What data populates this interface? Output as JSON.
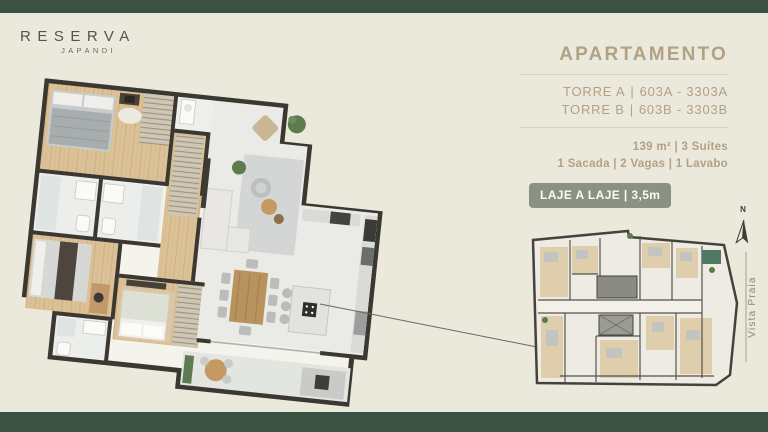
{
  "brand": {
    "name": "RESERVA",
    "sub": "JAPANDI"
  },
  "panel": {
    "title": "APARTAMENTO",
    "separator": "|",
    "towers": [
      {
        "label": "TORRE A",
        "units": "603A - 3303A"
      },
      {
        "label": "TORRE B",
        "units": "603B - 3303B"
      }
    ],
    "specs": [
      "139 m² | 3 Suítes",
      "1 Sacada | 2 Vagas | 1 Lavabo"
    ],
    "badge": "LAJE A LAJE | 3,5m"
  },
  "keyplan": {
    "compass_n": "N",
    "view_label": "Vista Praia"
  },
  "colors": {
    "bar_green": "#3A5143",
    "background_cream": "#EBE9DC",
    "accent_tan": "#B2A184",
    "badge_green": "#8B9283",
    "wall_dark": "#3B3831",
    "wood_floor": "#DCC096",
    "tile_floor": "#EAEBE6",
    "plant_green": "#5D7B4F"
  }
}
